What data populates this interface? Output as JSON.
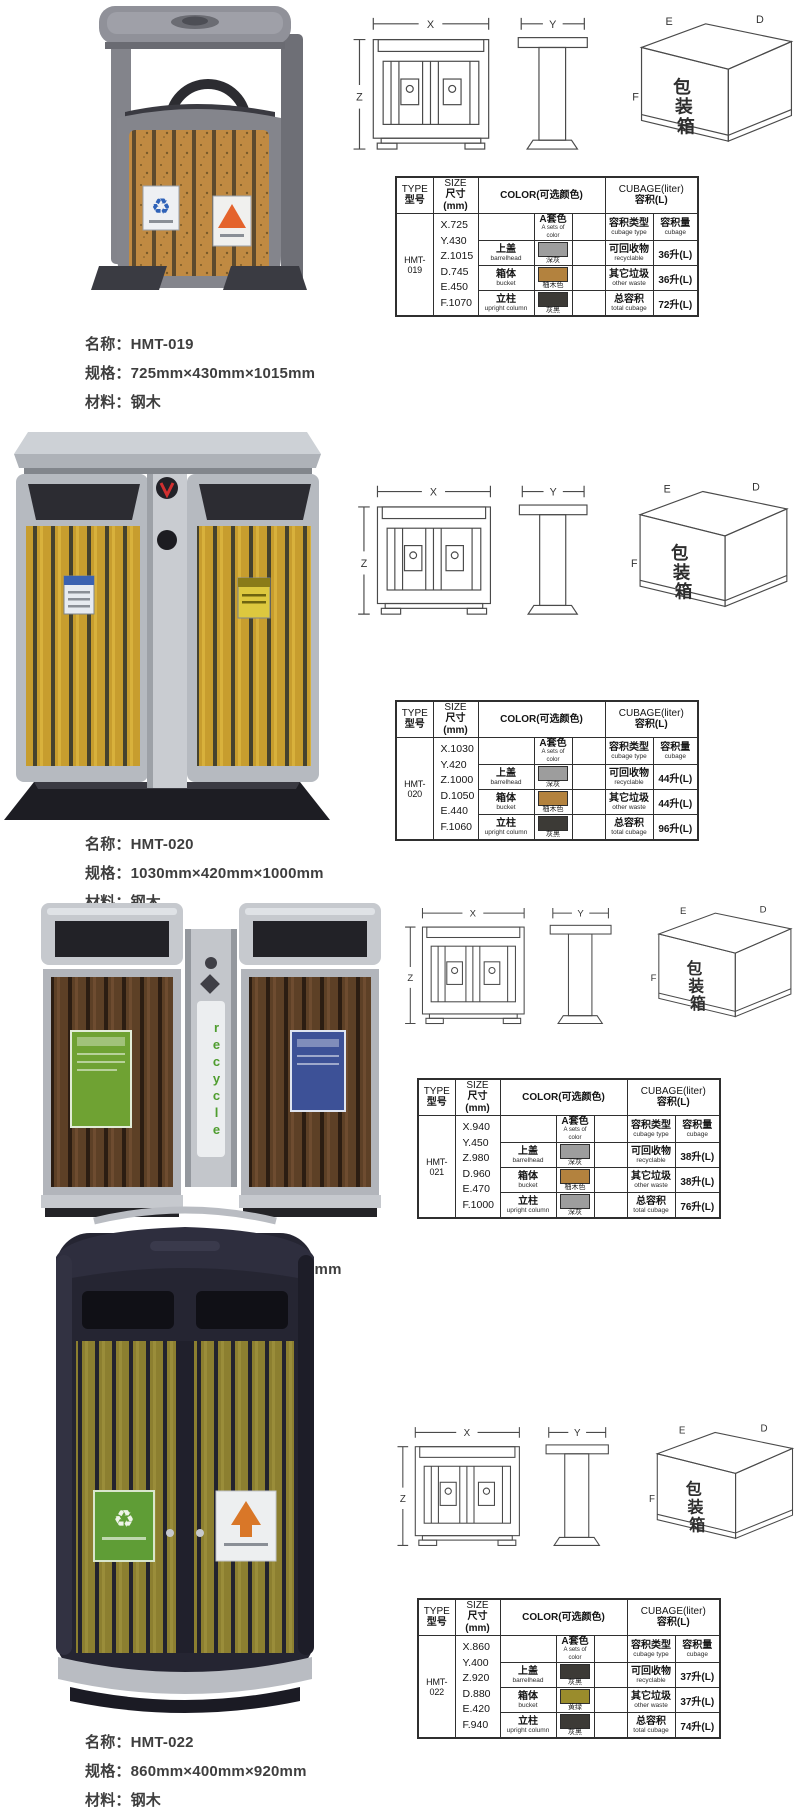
{
  "page": {
    "background": "#ffffff"
  },
  "caption_labels": {
    "name": "名称：",
    "spec": "规格：",
    "material": "材料："
  },
  "drawing_labels": {
    "x": "X",
    "y": "Y",
    "z": "Z",
    "e": "E",
    "d": "D",
    "f": "F",
    "box_chars": [
      "包",
      "装",
      "箱"
    ]
  },
  "table_header": {
    "type_en": "TYPE",
    "type_cn": "型号",
    "size_en": "SIZE",
    "size_cn": "尺寸(mm)",
    "color": "COLOR(可选颜色)",
    "cubage_en": "CUBAGE(liter)",
    "cubage_cn": "容积(L)"
  },
  "table_subheader": {
    "a_color_cn": "A套色",
    "a_color_en": "A sets of color",
    "cubage_type_cn": "容积类型",
    "cubage_type_en": "cubage type",
    "cubage_amount_cn": "容积量",
    "cubage_amount_en": "cubage"
  },
  "swatch_colors": {
    "dark_gray": "#9d9d9d",
    "teak": "#b3823e",
    "gray_black": "#3c3a36",
    "yellow_green": "#9a8c2c"
  },
  "products": [
    {
      "model": "HMT-019",
      "caption": {
        "name": "HMT-019",
        "spec": "725mm×430mm×1015mm",
        "material": "钢木"
      },
      "sizes": [
        "X.725",
        "Y.430",
        "Z.1015",
        "D.745",
        "E.450",
        "F.1070"
      ],
      "colors": [
        {
          "part_cn": "上盖",
          "part_en": "barrelhead",
          "hex": "#9d9d9d",
          "label": "深灰"
        },
        {
          "part_cn": "箱体",
          "part_en": "bucket",
          "hex": "#b3823e",
          "label": "柚木色"
        },
        {
          "part_cn": "立柱",
          "part_en": "upright column",
          "hex": "#3c3a36",
          "label": "灰黑"
        }
      ],
      "cubage": [
        {
          "cn": "可回收物",
          "en": "recyclable",
          "value": "36升(L)"
        },
        {
          "cn": "其它垃圾",
          "en": "other waste",
          "value": "36升(L)"
        },
        {
          "cn": "总容积",
          "en": "total cubage",
          "value": "72升(L)"
        }
      ]
    },
    {
      "model": "HMT-020",
      "caption": {
        "name": "HMT-020",
        "spec": "1030mm×420mm×1000mm",
        "material": "钢木"
      },
      "sizes": [
        "X.1030",
        "Y.420",
        "Z.1000",
        "D.1050",
        "E.440",
        "F.1060"
      ],
      "colors": [
        {
          "part_cn": "上盖",
          "part_en": "barrelhead",
          "hex": "#9d9d9d",
          "label": "深灰"
        },
        {
          "part_cn": "箱体",
          "part_en": "bucket",
          "hex": "#b3823e",
          "label": "柚木色"
        },
        {
          "part_cn": "立柱",
          "part_en": "upright column",
          "hex": "#3c3a36",
          "label": "灰黑"
        }
      ],
      "cubage": [
        {
          "cn": "可回收物",
          "en": "recyclable",
          "value": "44升(L)"
        },
        {
          "cn": "其它垃圾",
          "en": "other waste",
          "value": "44升(L)"
        },
        {
          "cn": "总容积",
          "en": "total cubage",
          "value": "96升(L)"
        }
      ]
    },
    {
      "model": "HMT-021",
      "caption": {
        "name": "HMT-021",
        "spec": "940mm×450mm×980mm",
        "material": "钢木"
      },
      "sizes": [
        "X.940",
        "Y.450",
        "Z.980",
        "D.960",
        "E.470",
        "F.1000"
      ],
      "colors": [
        {
          "part_cn": "上盖",
          "part_en": "barrelhead",
          "hex": "#9d9d9d",
          "label": "深灰"
        },
        {
          "part_cn": "箱体",
          "part_en": "bucket",
          "hex": "#b3823e",
          "label": "柚木色"
        },
        {
          "part_cn": "立柱",
          "part_en": "upright column",
          "hex": "#9d9d9d",
          "label": "深灰"
        }
      ],
      "cubage": [
        {
          "cn": "可回收物",
          "en": "recyclable",
          "value": "38升(L)"
        },
        {
          "cn": "其它垃圾",
          "en": "other waste",
          "value": "38升(L)"
        },
        {
          "cn": "总容积",
          "en": "total cubage",
          "value": "76升(L)"
        }
      ],
      "photo_text": "recycle"
    },
    {
      "model": "HMT-022",
      "caption": {
        "name": "HMT-022",
        "spec": "860mm×400mm×920mm",
        "material": "钢木"
      },
      "sizes": [
        "X.860",
        "Y.400",
        "Z.920",
        "D.880",
        "E.420",
        "F.940"
      ],
      "colors": [
        {
          "part_cn": "上盖",
          "part_en": "barrelhead",
          "hex": "#3c3a36",
          "label": "灰黑"
        },
        {
          "part_cn": "箱体",
          "part_en": "bucket",
          "hex": "#9a8c2c",
          "label": "黄绿"
        },
        {
          "part_cn": "立柱",
          "part_en": "upright column",
          "hex": "#3c3a36",
          "label": "灰黑"
        }
      ],
      "cubage": [
        {
          "cn": "可回收物",
          "en": "recyclable",
          "value": "37升(L)"
        },
        {
          "cn": "其它垃圾",
          "en": "other waste",
          "value": "37升(L)"
        },
        {
          "cn": "总容积",
          "en": "total cubage",
          "value": "74升(L)"
        }
      ]
    }
  ]
}
